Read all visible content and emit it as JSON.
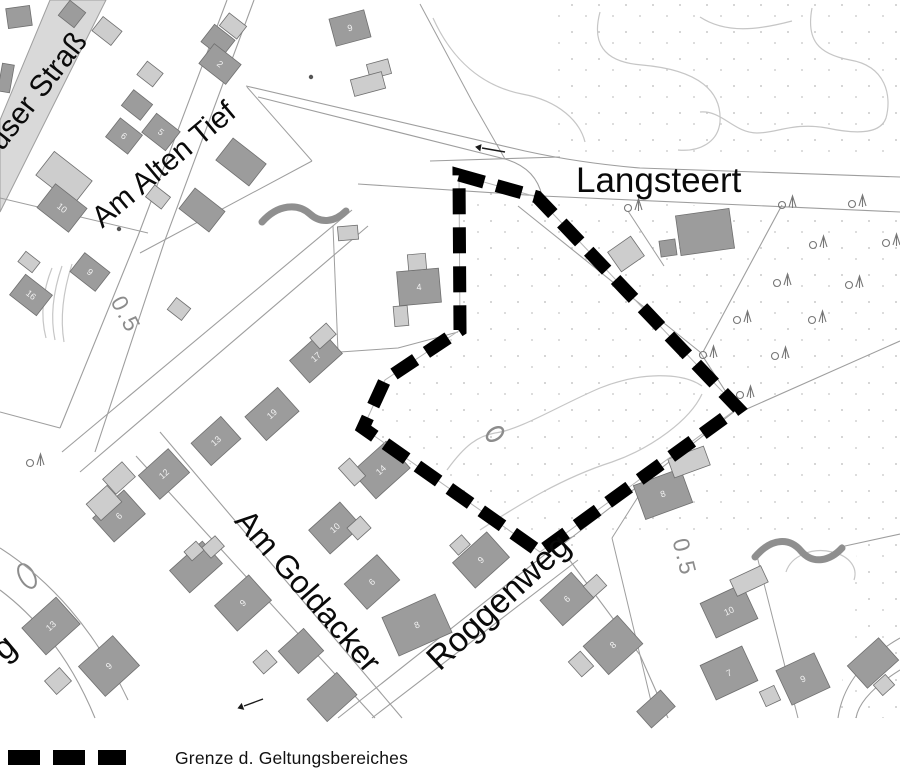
{
  "legend": {
    "label": "Grenze d. Geltungsbereiches"
  },
  "map": {
    "width": 900,
    "height": 776,
    "colors": {
      "background": "#ffffff",
      "building_dark": "#9c9c9c",
      "building_light": "#cdcdcd",
      "building_stroke": "#6f6f6f",
      "line": "#9e9e9e",
      "contour": "#c6c6c6",
      "dots": "#c9c9c9",
      "stream": "#8f8f8f",
      "boundary": "#000000",
      "road_fill": "#d9d9d9",
      "label": "#0a0a0a",
      "contour_label": "#8c8c8c",
      "number": "#f2f2f2",
      "tree": "#777777"
    },
    "street_labels": [
      {
        "name": "langsteert",
        "text": "Langsteert",
        "x": 576,
        "y": 192,
        "rot": 0,
        "size": 35,
        "anchor": "start"
      },
      {
        "name": "am-alten-tief",
        "text": "Am Alten Tief",
        "x": 170,
        "y": 172,
        "rot": -40,
        "size": 30,
        "anchor": "middle"
      },
      {
        "name": "haeuser-strasse",
        "text": "user Straß",
        "x": 2,
        "y": 152,
        "rot": -52,
        "size": 30,
        "anchor": "start"
      },
      {
        "name": "am-goldacker",
        "text": "Am Goldacker",
        "x": 300,
        "y": 598,
        "rot": 49,
        "size": 32,
        "anchor": "middle"
      },
      {
        "name": "roggenweg",
        "text": "Roggenweg",
        "x": 506,
        "y": 610,
        "rot": -43,
        "size": 34,
        "anchor": "middle"
      },
      {
        "name": "street-partial-g",
        "text": "g",
        "x": 4,
        "y": 662,
        "rot": -40,
        "size": 34,
        "anchor": "start"
      }
    ],
    "contour_labels": [
      {
        "text": "0.5",
        "x": 119,
        "y": 318,
        "rot": 62,
        "size": 23
      },
      {
        "text": "0.5",
        "x": 677,
        "y": 559,
        "rot": 76,
        "size": 23
      }
    ],
    "rings": [
      {
        "cx": 495,
        "cy": 434,
        "rx": 9,
        "ry": 5.5,
        "rot": -35,
        "w": 2.4
      },
      {
        "cx": 27,
        "cy": 576,
        "rx": 7,
        "ry": 13,
        "rot": -30,
        "w": 2
      }
    ],
    "boundary": {
      "points": [
        [
          459,
          175
        ],
        [
          537,
          197
        ],
        [
          738,
          408
        ],
        [
          540,
          552
        ],
        [
          363,
          428
        ],
        [
          385,
          380
        ],
        [
          460,
          330
        ]
      ],
      "dash": [
        26,
        13
      ],
      "width": 13
    },
    "road_fill_polygon": [
      [
        50,
        0
      ],
      [
        106,
        0
      ],
      [
        0,
        212
      ],
      [
        0,
        120
      ]
    ],
    "roads": [
      "M246,86 L525,151 Q580,163 640,168 L900,177",
      "M430,161 L560,157",
      "M258,97 L505,159 Q536,168 542,196",
      "M358,184 L542,196 L900,212",
      "M227,0 L138,236 L60,428",
      "M254,0 L165,240 L95,452",
      "M352,210 L62,452",
      "M368,226 L80,472",
      "M160,432 L402,718",
      "M136,456 L375,718",
      "M338,718 L548,552 Q562,540 575,536",
      "M372,718 L578,560",
      "M562,545 L735,411",
      "M568,558 L640,655 L668,718",
      "M518,206 L700,352",
      "M782,205 L703,352",
      "M700,352 L737,409",
      "M740,412 L900,341",
      "M845,546 L900,534",
      "M900,638 C858,662 842,690 838,718",
      "M900,670 C868,690 858,706 856,718",
      "M0,548 C50,580 95,630 128,700",
      "M0,590 C40,620 72,662 95,718"
    ],
    "parcels": [
      "M140,253 L312,161",
      "M312,161 L247,87",
      "M420,4 L473,103",
      "M473,103 L505,159",
      "M628,211 L664,266",
      "M148,233 L0,198",
      "M60,428 L0,412",
      "M612,538 L655,718",
      "M757,556 L798,718",
      "M655,470 L612,538",
      "M333,226 L338,352",
      "M340,352 L398,348 L458,332"
    ],
    "contours": [
      "M433,18 C452,60 482,86 522,94 C560,101 580,122 585,142",
      "M600,12 C592,42 602,62 642,65 C700,70 722,92 720,122 C718,142 700,152 678,150",
      "M700,17 C726,34 758,30 792,21",
      "M812,8 C806,40 818,54 850,60 C886,66 892,96 886,118 C880,136 850,133 827,128 C794,122 777,133 757,133 C734,133 722,110 700,112",
      "M447,470 C465,445 478,436 495,433 C520,430 560,405 600,388 C640,372 682,372 702,386",
      "M480,530 C520,504 562,478 612,462 C652,448 690,420 702,394",
      "M52,268 C43,290 40,315 46,338",
      "M62,266 C53,292 50,316 55,340",
      "M72,264 C63,292 60,318 64,342",
      "M786,572 C791,556 812,547 832,552 C850,556 858,568 854,580"
    ],
    "streams": [
      "M262,222 C278,204 298,203 310,214 C321,224 335,222 346,211",
      "M755,557 C772,537 790,538 801,551 C813,565 830,561 842,548"
    ],
    "buildings": [
      [
        19,
        17,
        24,
        20,
        -8,
        "d",
        ""
      ],
      [
        72,
        14,
        20,
        19,
        38,
        "d",
        ""
      ],
      [
        6,
        78,
        12,
        28,
        10,
        "d",
        ""
      ],
      [
        107,
        31,
        24,
        18,
        38,
        "l",
        ""
      ],
      [
        218,
        41,
        26,
        22,
        38,
        "d",
        ""
      ],
      [
        233,
        26,
        22,
        16,
        38,
        "l",
        ""
      ],
      [
        220,
        64,
        34,
        25,
        38,
        "d",
        "2"
      ],
      [
        150,
        74,
        20,
        17,
        38,
        "l",
        ""
      ],
      [
        137,
        105,
        24,
        20,
        38,
        "d",
        ""
      ],
      [
        161,
        132,
        30,
        24,
        38,
        "d",
        "5"
      ],
      [
        124,
        136,
        28,
        24,
        38,
        "d",
        "6"
      ],
      [
        64,
        178,
        48,
        30,
        38,
        "l",
        ""
      ],
      [
        62,
        208,
        40,
        30,
        38,
        "d",
        "10"
      ],
      [
        31,
        295,
        34,
        26,
        38,
        "d",
        "16"
      ],
      [
        29,
        262,
        18,
        13,
        38,
        "l",
        ""
      ],
      [
        90,
        272,
        32,
        24,
        38,
        "d",
        "9"
      ],
      [
        350,
        28,
        36,
        28,
        -15,
        "d",
        "9"
      ],
      [
        379,
        69,
        22,
        15,
        -15,
        "l",
        ""
      ],
      [
        368,
        84,
        32,
        17,
        -15,
        "l",
        ""
      ],
      [
        241,
        162,
        42,
        28,
        38,
        "d",
        ""
      ],
      [
        202,
        210,
        38,
        26,
        38,
        "d",
        ""
      ],
      [
        158,
        197,
        20,
        15,
        38,
        "l",
        ""
      ],
      [
        348,
        233,
        20,
        14,
        -5,
        "l",
        ""
      ],
      [
        419,
        287,
        42,
        34,
        -5,
        "d",
        "4"
      ],
      [
        417,
        262,
        18,
        16,
        -5,
        "l",
        ""
      ],
      [
        401,
        316,
        14,
        20,
        -5,
        "l",
        ""
      ],
      [
        316,
        357,
        44,
        30,
        -42,
        "d",
        "17"
      ],
      [
        323,
        336,
        22,
        15,
        -42,
        "l",
        ""
      ],
      [
        179,
        309,
        18,
        15,
        38,
        "l",
        ""
      ],
      [
        381,
        470,
        46,
        36,
        -42,
        "d",
        "14"
      ],
      [
        352,
        472,
        15,
        24,
        -42,
        "l",
        ""
      ],
      [
        272,
        414,
        44,
        32,
        -42,
        "d",
        "19"
      ],
      [
        216,
        441,
        40,
        30,
        -42,
        "d",
        "13"
      ],
      [
        164,
        474,
        40,
        32,
        -42,
        "d",
        "12"
      ],
      [
        119,
        478,
        26,
        20,
        -42,
        "l",
        ""
      ],
      [
        119,
        516,
        42,
        32,
        -42,
        "d",
        "6"
      ],
      [
        104,
        503,
        28,
        22,
        -42,
        "l",
        ""
      ],
      [
        51,
        626,
        46,
        36,
        -42,
        "d",
        "13"
      ],
      [
        109,
        666,
        46,
        40,
        -42,
        "d",
        "9"
      ],
      [
        58,
        681,
        20,
        18,
        -42,
        "l",
        ""
      ],
      [
        196,
        567,
        44,
        30,
        -42,
        "d",
        ""
      ],
      [
        213,
        547,
        18,
        14,
        -42,
        "l",
        ""
      ],
      [
        243,
        603,
        46,
        34,
        -42,
        "d",
        "9"
      ],
      [
        335,
        528,
        42,
        32,
        -42,
        "d",
        "10"
      ],
      [
        359,
        528,
        18,
        16,
        -42,
        "l",
        ""
      ],
      [
        372,
        582,
        44,
        34,
        -42,
        "d",
        "6"
      ],
      [
        417,
        625,
        58,
        42,
        -24,
        "d",
        "8"
      ],
      [
        301,
        651,
        34,
        30,
        -42,
        "d",
        ""
      ],
      [
        332,
        697,
        40,
        30,
        -42,
        "d",
        ""
      ],
      [
        265,
        662,
        18,
        16,
        -42,
        "l",
        ""
      ],
      [
        481,
        560,
        46,
        34,
        -42,
        "d",
        "9"
      ],
      [
        460,
        545,
        16,
        13,
        -42,
        "l",
        ""
      ],
      [
        567,
        599,
        42,
        34,
        -42,
        "d",
        "6"
      ],
      [
        595,
        586,
        18,
        15,
        -42,
        "l",
        ""
      ],
      [
        613,
        645,
        46,
        38,
        -42,
        "d",
        "8"
      ],
      [
        581,
        664,
        16,
        20,
        -42,
        "l",
        ""
      ],
      [
        729,
        611,
        46,
        38,
        -25,
        "d",
        "10"
      ],
      [
        749,
        581,
        34,
        18,
        -25,
        "l",
        ""
      ],
      [
        729,
        673,
        46,
        38,
        -25,
        "d",
        "7"
      ],
      [
        803,
        679,
        42,
        38,
        -25,
        "d",
        "9"
      ],
      [
        770,
        696,
        16,
        16,
        -25,
        "l",
        ""
      ],
      [
        873,
        663,
        42,
        30,
        -42,
        "d",
        ""
      ],
      [
        884,
        685,
        16,
        14,
        -42,
        "l",
        ""
      ],
      [
        656,
        709,
        32,
        22,
        -42,
        "d",
        ""
      ],
      [
        663,
        494,
        50,
        36,
        -20,
        "d",
        "8"
      ],
      [
        689,
        462,
        38,
        20,
        -20,
        "l",
        ""
      ],
      [
        705,
        232,
        54,
        40,
        -8,
        "d",
        ""
      ],
      [
        668,
        248,
        16,
        16,
        -8,
        "d",
        ""
      ],
      [
        626,
        254,
        28,
        24,
        -35,
        "l",
        ""
      ],
      [
        194,
        551,
        16,
        12,
        -42,
        "l",
        ""
      ]
    ],
    "trees": [
      [
        628,
        206
      ],
      [
        782,
        203
      ],
      [
        852,
        202
      ],
      [
        813,
        243
      ],
      [
        886,
        241
      ],
      [
        777,
        281
      ],
      [
        849,
        283
      ],
      [
        737,
        318
      ],
      [
        812,
        318
      ],
      [
        703,
        353
      ],
      [
        775,
        354
      ],
      [
        740,
        393
      ],
      [
        30,
        461
      ]
    ],
    "arrows": [
      {
        "x1": 505,
        "y1": 152,
        "x2": 482,
        "y2": 148
      },
      {
        "x1": 263,
        "y1": 699,
        "x2": 244,
        "y2": 706
      }
    ],
    "point_markers": [
      [
        119,
        229
      ],
      [
        311,
        77
      ]
    ],
    "dot_regions": [
      [
        [
          555,
          0
        ],
        [
          900,
          0
        ],
        [
          900,
          160
        ],
        [
          555,
          160
        ]
      ],
      [
        [
          462,
          172
        ],
        [
          537,
          197
        ],
        [
          900,
          216
        ],
        [
          900,
          530
        ],
        [
          845,
          545
        ],
        [
          618,
          534
        ],
        [
          540,
          556
        ],
        [
          362,
          430
        ],
        [
          385,
          380
        ],
        [
          460,
          330
        ]
      ],
      [
        [
          858,
          545
        ],
        [
          900,
          534
        ],
        [
          900,
          718
        ],
        [
          838,
          718
        ]
      ]
    ]
  }
}
